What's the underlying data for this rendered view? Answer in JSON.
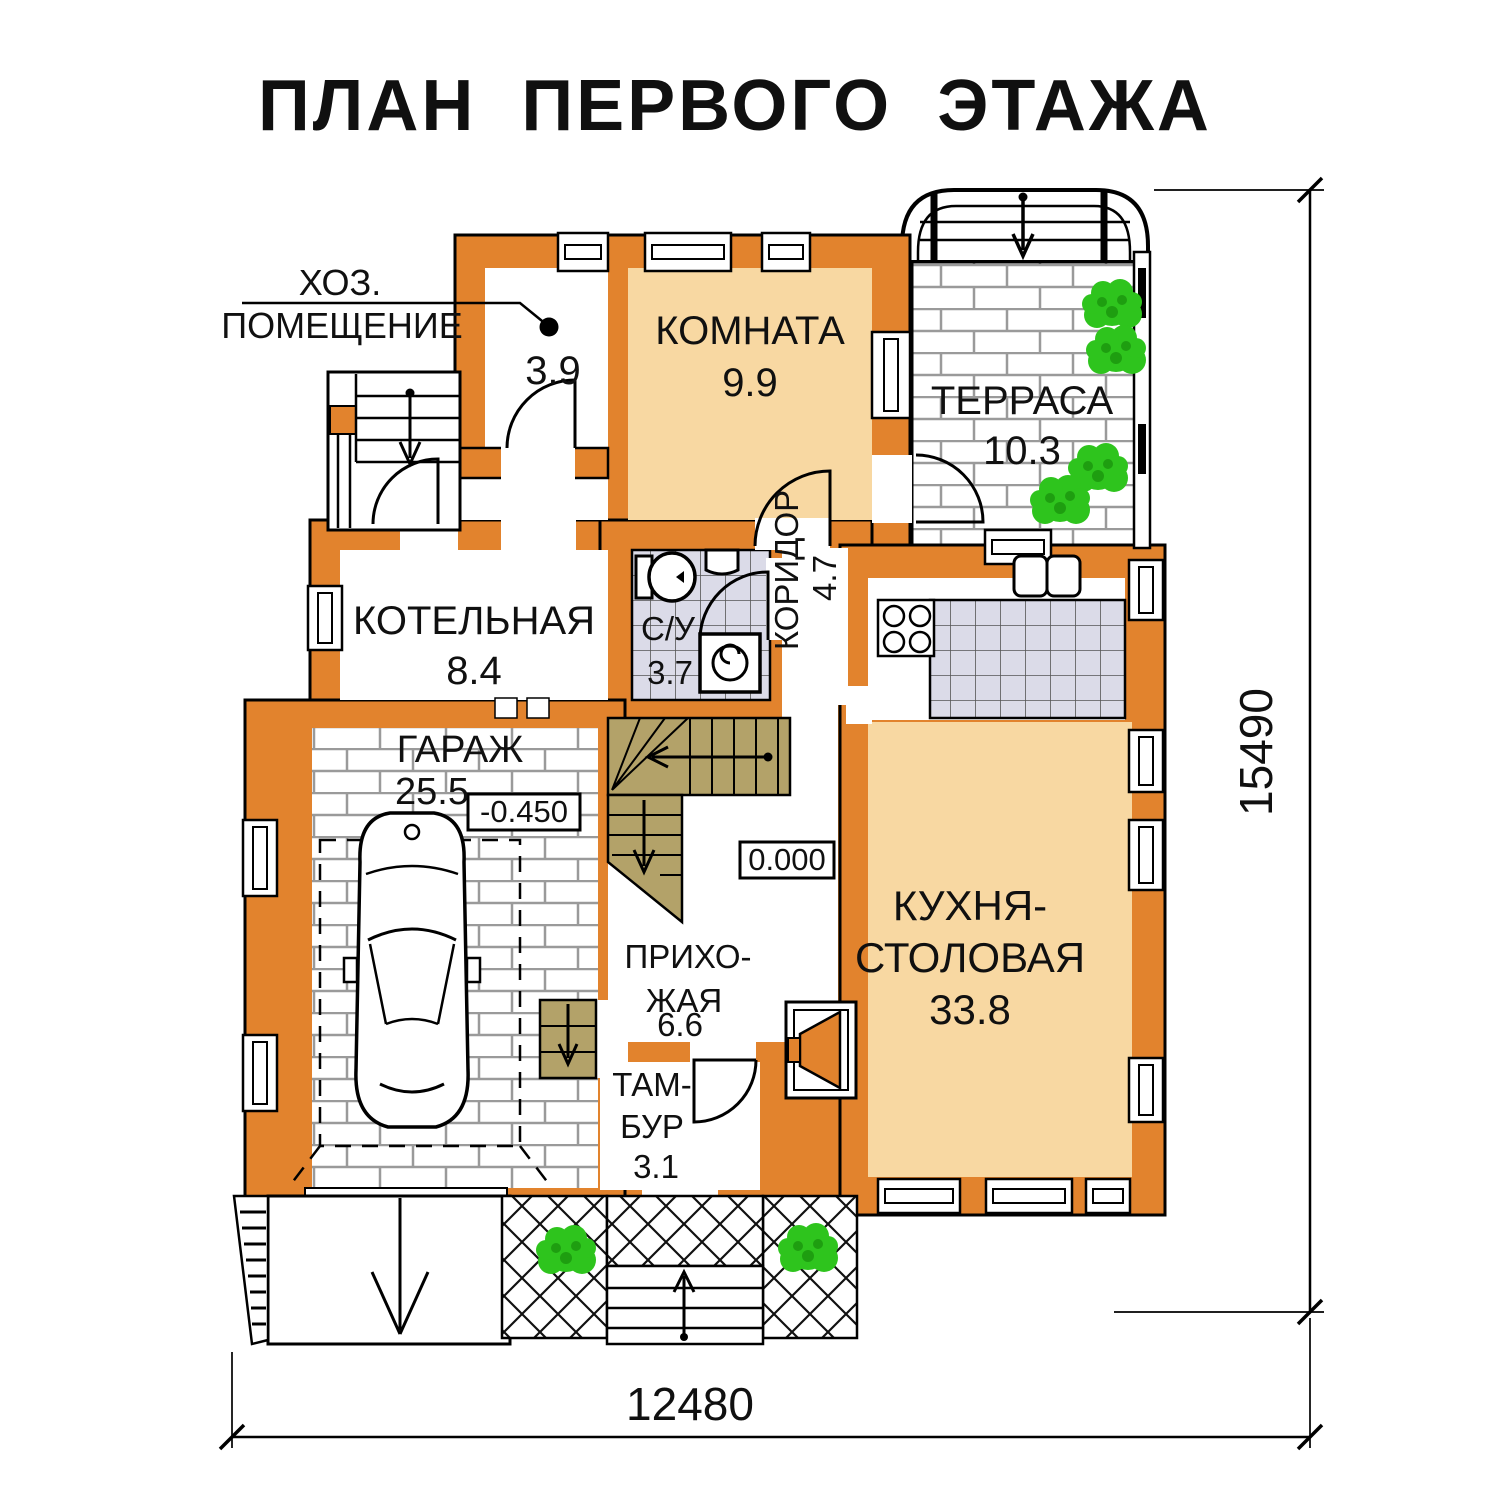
{
  "title": "ПЛАН ПЕРВОГО ЭТАЖА",
  "rooms": {
    "hoz": {
      "label_line1": "ХОЗ.",
      "label_line2": "ПОМЕЩЕНИЕ",
      "area": "3.9"
    },
    "komnata": {
      "name": "КОМНАТА",
      "area": "9.9"
    },
    "terrasa": {
      "name": "ТЕРРАСА",
      "area": "10.3"
    },
    "kotelnaya": {
      "name": "КОТЕЛЬНАЯ",
      "area": "8.4"
    },
    "su": {
      "name": "С/У",
      "area": "3.7"
    },
    "koridor": {
      "name": "КОРИДОР",
      "area": "4.7"
    },
    "garazh": {
      "name": "ГАРАЖ",
      "area": "25.5"
    },
    "prihozhaya": {
      "name_line1": "ПРИХО-",
      "name_line2": "ЖАЯ",
      "area": "6.6"
    },
    "tambur": {
      "name_line1": "ТАМ-",
      "name_line2": "БУР",
      "area": "3.1"
    },
    "kuhnya": {
      "name_line1": "КУХНЯ-",
      "name_line2": "СТОЛОВАЯ",
      "area": "33.8"
    }
  },
  "elevations": {
    "garage": "-0.450",
    "ground": "0.000"
  },
  "dimensions": {
    "width": "12480",
    "height": "15490"
  },
  "colors": {
    "wall": "#E2832D",
    "room_fill": "#F8D8A2",
    "stair_fill": "#B3A269",
    "tile_fill": "#DBDBE8",
    "plant": "#2EC41D"
  }
}
